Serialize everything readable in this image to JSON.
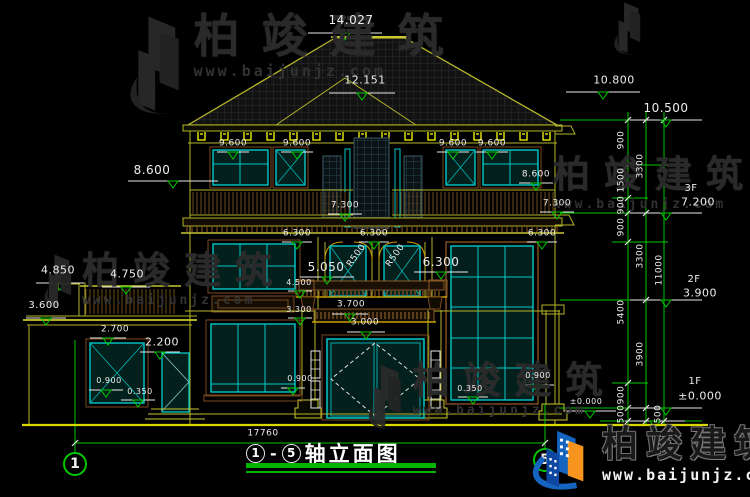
{
  "colors": {
    "background": "#000000",
    "dim_green": "#00c800",
    "line_olive": "#b4b428",
    "bright_yellow": "#ffff00",
    "window_teal": "#00c8c8",
    "trim_brown": "#7a4a1e",
    "text_white": "#ededed",
    "logo_blue": "#1565c0",
    "logo_orange": "#f7941d"
  },
  "axes": {
    "start": "1",
    "end": "5"
  },
  "title_block": {
    "axis_start": "1",
    "dash": "-",
    "axis_end": "5",
    "title": "轴立面图"
  },
  "watermark": {
    "brand": "柏竣建筑",
    "url": "www.baijunjz.com",
    "instances": [
      {
        "x": 126,
        "y": 12,
        "icon": true,
        "iconH": 112,
        "font": 46,
        "ls": 22,
        "urlFont": 15
      },
      {
        "x": 42,
        "y": 252,
        "icon": true,
        "iconH": 62,
        "font": 37,
        "ls": 14,
        "urlFont": 13
      },
      {
        "x": 553,
        "y": 156,
        "icon": false,
        "font": 37,
        "ls": 14,
        "urlFont": 13
      },
      {
        "x": 366,
        "y": 362,
        "icon": true,
        "iconH": 74,
        "font": 37,
        "ls": 14,
        "urlFont": 13
      },
      {
        "x": 612,
        "y": 0,
        "icon": true,
        "iconH": 60,
        "iconOnly": true
      }
    ]
  },
  "labels": [
    {
      "t": "14.027",
      "x": 351,
      "y": 20,
      "s": 12
    },
    {
      "t": "12.151",
      "x": 365,
      "y": 80,
      "s": 11
    },
    {
      "t": "10.800",
      "x": 614,
      "y": 80,
      "s": 11
    },
    {
      "t": "10.500",
      "x": 666,
      "y": 108,
      "s": 12
    },
    {
      "t": "9.600",
      "x": 233,
      "y": 144,
      "s": 9
    },
    {
      "t": "9.600",
      "x": 297,
      "y": 144,
      "s": 9
    },
    {
      "t": "9.600",
      "x": 453,
      "y": 144,
      "s": 9
    },
    {
      "t": "9.600",
      "x": 492,
      "y": 144,
      "s": 9
    },
    {
      "t": "8.600",
      "x": 152,
      "y": 170,
      "s": 12
    },
    {
      "t": "8.600",
      "x": 536,
      "y": 175,
      "s": 9
    },
    {
      "t": "7.300",
      "x": 345,
      "y": 206,
      "s": 9
    },
    {
      "t": "7.300",
      "x": 557,
      "y": 204,
      "s": 9
    },
    {
      "t": "3F",
      "x": 691,
      "y": 189,
      "s": 10
    },
    {
      "t": "7.200",
      "x": 698,
      "y": 202,
      "s": 11
    },
    {
      "t": "6.300",
      "x": 297,
      "y": 234,
      "s": 9
    },
    {
      "t": "6.300",
      "x": 374,
      "y": 234,
      "s": 9
    },
    {
      "t": "6.300",
      "x": 542,
      "y": 234,
      "s": 9
    },
    {
      "t": "R500",
      "x": 357,
      "y": 256,
      "s": 9,
      "r": -55
    },
    {
      "t": "R500",
      "x": 396,
      "y": 256,
      "s": 9,
      "r": -55
    },
    {
      "t": "6.300",
      "x": 441,
      "y": 262,
      "s": 12
    },
    {
      "t": "5.050",
      "x": 326,
      "y": 267,
      "s": 12
    },
    {
      "t": "4.850",
      "x": 58,
      "y": 270,
      "s": 11
    },
    {
      "t": "4.750",
      "x": 127,
      "y": 274,
      "s": 11
    },
    {
      "t": "4.500",
      "x": 299,
      "y": 283,
      "s": 8
    },
    {
      "t": "3.300",
      "x": 299,
      "y": 310,
      "s": 8
    },
    {
      "t": "3.600",
      "x": 44,
      "y": 306,
      "s": 10
    },
    {
      "t": "2.700",
      "x": 115,
      "y": 330,
      "s": 9
    },
    {
      "t": "2.200",
      "x": 162,
      "y": 342,
      "s": 11
    },
    {
      "t": "3.700",
      "x": 351,
      "y": 305,
      "s": 9
    },
    {
      "t": "3.000",
      "x": 365,
      "y": 323,
      "s": 9
    },
    {
      "t": "2F",
      "x": 694,
      "y": 280,
      "s": 10
    },
    {
      "t": "3.900",
      "x": 700,
      "y": 293,
      "s": 11
    },
    {
      "t": "1F",
      "x": 695,
      "y": 382,
      "s": 10
    },
    {
      "t": "±0.000",
      "x": 700,
      "y": 396,
      "s": 11
    },
    {
      "t": "±0.000",
      "x": 586,
      "y": 402,
      "s": 8
    },
    {
      "t": "0.900",
      "x": 109,
      "y": 381,
      "s": 8
    },
    {
      "t": "0.350",
      "x": 140,
      "y": 392,
      "s": 8
    },
    {
      "t": "0.900",
      "x": 300,
      "y": 379,
      "s": 8
    },
    {
      "t": "0.350",
      "x": 470,
      "y": 389,
      "s": 8
    },
    {
      "t": "0.900",
      "x": 538,
      "y": 376,
      "s": 8
    },
    {
      "t": "17760",
      "x": 263,
      "y": 434,
      "s": 9
    },
    {
      "t": "900",
      "x": 622,
      "y": 140,
      "s": 9,
      "r": -90
    },
    {
      "t": "1500",
      "x": 622,
      "y": 180,
      "s": 9,
      "r": -90
    },
    {
      "t": "900",
      "x": 622,
      "y": 205,
      "s": 9,
      "r": -90
    },
    {
      "t": "900",
      "x": 622,
      "y": 227,
      "s": 9,
      "r": -90
    },
    {
      "t": "5400",
      "x": 622,
      "y": 312,
      "s": 9,
      "r": -90
    },
    {
      "t": "900",
      "x": 622,
      "y": 395,
      "s": 9,
      "r": -90
    },
    {
      "t": "500",
      "x": 622,
      "y": 414,
      "s": 9,
      "r": -90
    },
    {
      "t": "3300",
      "x": 641,
      "y": 166,
      "s": 9,
      "r": -90
    },
    {
      "t": "3300",
      "x": 641,
      "y": 256,
      "s": 9,
      "r": -90
    },
    {
      "t": "3900",
      "x": 641,
      "y": 354,
      "s": 9,
      "r": -90
    },
    {
      "t": "500",
      "x": 659,
      "y": 414,
      "s": 9,
      "r": -90
    },
    {
      "t": "11000",
      "x": 660,
      "y": 270,
      "s": 9,
      "r": -90
    }
  ]
}
